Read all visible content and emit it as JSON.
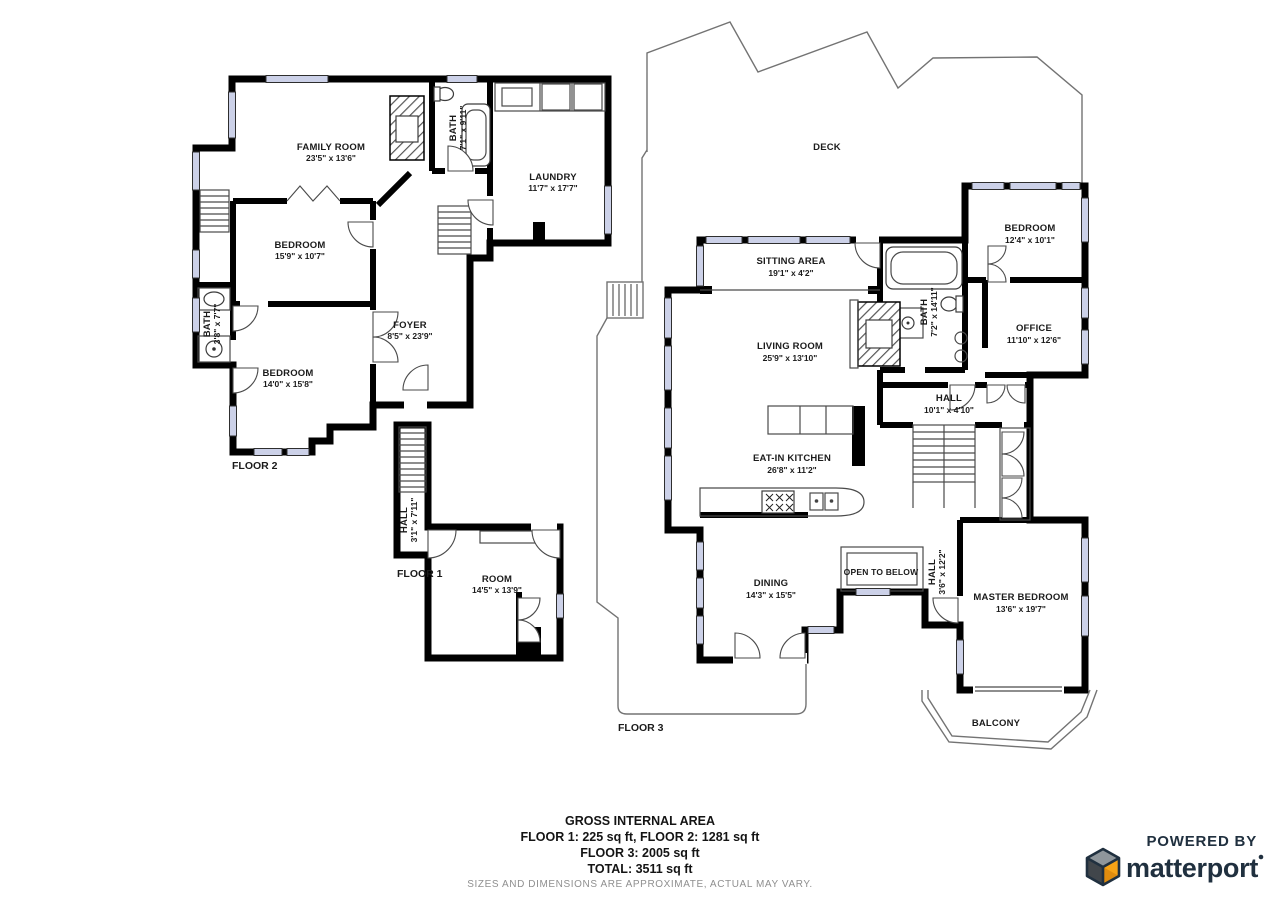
{
  "colors": {
    "wall": "#000000",
    "window": "#ccd1e8",
    "text": "#1b1b1b",
    "brand_navy": "#20303f",
    "brand_orange": "#f7a316"
  },
  "floor2": {
    "label": "FLOOR 2",
    "family_room": {
      "name": "FAMILY ROOM",
      "dims": "23'5\" x 13'6\""
    },
    "bath_top": {
      "name": "BATH",
      "dims": "7'1\" x 9'11\""
    },
    "laundry": {
      "name": "LAUNDRY",
      "dims": "11'7\" x 17'7\""
    },
    "bedroom_upper": {
      "name": "BEDROOM",
      "dims": "15'9\" x 10'7\""
    },
    "foyer": {
      "name": "FOYER",
      "dims": "8'5\" x 23'9\""
    },
    "bath_left": {
      "name": "BATH",
      "dims": "3'8\" x 7'7\""
    },
    "bedroom_lower": {
      "name": "BEDROOM",
      "dims": "14'0\" x 15'8\""
    }
  },
  "floor1": {
    "label": "FLOOR 1",
    "hall": {
      "name": "HALL",
      "dims": "3'1\" x 7'11\""
    },
    "room": {
      "name": "ROOM",
      "dims": "14'5\" x 13'9\""
    }
  },
  "floor3": {
    "label": "FLOOR 3",
    "deck": {
      "name": "DECK"
    },
    "sitting_area": {
      "name": "SITTING AREA",
      "dims": "19'1\" x 4'2\""
    },
    "bedroom": {
      "name": "BEDROOM",
      "dims": "12'4\" x 10'1\""
    },
    "bath": {
      "name": "BATH",
      "dims": "7'2\" x 14'11\""
    },
    "living_room": {
      "name": "LIVING ROOM",
      "dims": "25'9\" x 13'10\""
    },
    "office": {
      "name": "OFFICE",
      "dims": "11'10\" x 12'6\""
    },
    "hall_upper": {
      "name": "HALL",
      "dims": "10'1\" x 4'10\""
    },
    "kitchen": {
      "name": "EAT-IN KITCHEN",
      "dims": "26'8\" x 11'2\""
    },
    "open_below": {
      "name": "OPEN TO BELOW"
    },
    "hall_lower": {
      "name": "HALL",
      "dims": "3'6\" x 12'2\""
    },
    "dining": {
      "name": "DINING",
      "dims": "14'3\" x 15'5\""
    },
    "master": {
      "name": "MASTER BEDROOM",
      "dims": "13'6\" x 19'7\""
    },
    "balcony": {
      "name": "BALCONY"
    }
  },
  "footer": {
    "title": "GROSS INTERNAL AREA",
    "line1": "FLOOR 1: 225 sq ft, FLOOR 2: 1281 sq ft",
    "line2": "FLOOR 3: 2005 sq ft",
    "line3": "TOTAL: 3511 sq ft",
    "disclaimer": "SIZES AND DIMENSIONS ARE APPROXIMATE, ACTUAL MAY VARY."
  },
  "branding": {
    "powered_by": "POWERED BY",
    "brand": "matterport"
  }
}
